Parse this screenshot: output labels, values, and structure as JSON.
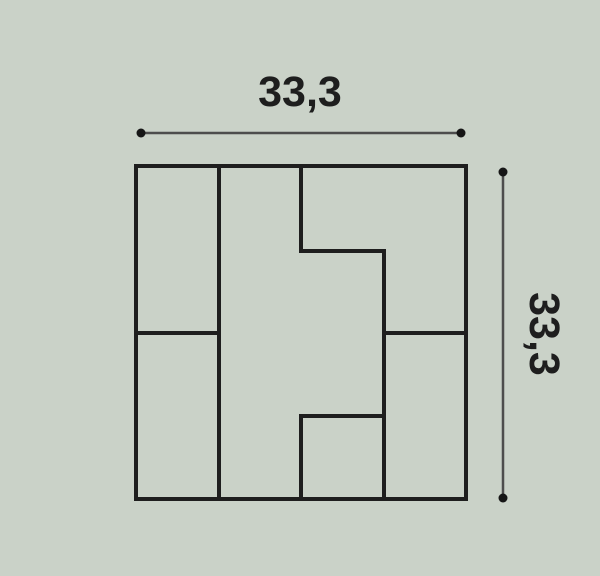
{
  "page": {
    "background_color": "#cad2c8"
  },
  "diagram": {
    "kind": "technical dimension drawing",
    "subject": "square decorative tile, front view, interlocking block pattern",
    "width_dimension": {
      "label": "33,3",
      "value": 33.3
    },
    "height_dimension": {
      "label": "33,3",
      "value": 33.3
    },
    "colors": {
      "background": "#cad2c8",
      "tile_outline": "#1e1e1e",
      "dimension_line": "#4d4d4d",
      "dimension_dot": "#161616",
      "label_text": "#1e1e1e"
    },
    "pattern": {
      "grid": "internal dividers at quarter positions (25%, 50%, 75%)",
      "pieces": [
        "left column top-half rectangle",
        "left column bottom-half rectangle",
        "center S-shaped interlocking block",
        "top-right L-shaped block",
        "right column bottom-half rectangle",
        "bottom-center small square"
      ]
    }
  }
}
